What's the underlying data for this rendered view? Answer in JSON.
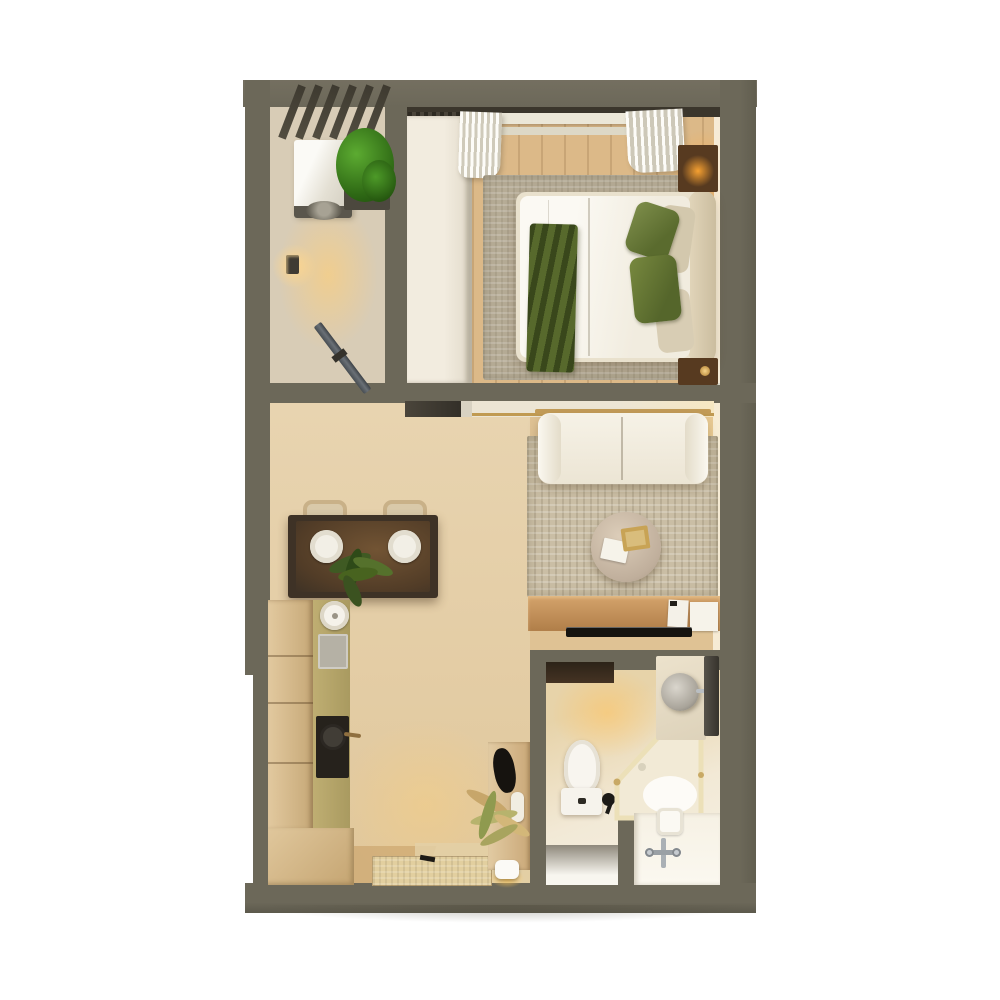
{
  "scene": {
    "type": "floor-plan-3d-render",
    "view": "top-down",
    "background_color": "#ffffff",
    "wall_color": "#6c6859"
  },
  "palette": {
    "wall": "#6c6859",
    "wood_floor_light": "#e6d1ab",
    "wood_floor_warm": "#dcb988",
    "bedroom_rug": "#b6ac96",
    "living_rug": "#cabea5",
    "sofa_cream": "#f3eee2",
    "accent_green_dark": "#4b5a26",
    "accent_green_pillow": "#6e7e3e",
    "gold": "#c39c58",
    "dark_table_wood": "#3e3226",
    "console_wood": "#c5925c",
    "white_fixture": "#f7f3ec",
    "plant_green": "#3f7a22"
  },
  "rooms": [
    {
      "name": "balcony",
      "items": [
        "pergola-slats",
        "washing-machine",
        "planter-plant",
        "wall-sconce",
        "drying-rack"
      ]
    },
    {
      "name": "bedroom",
      "items": [
        "wardrobe",
        "curtain-rod",
        "curtain-left",
        "curtain-right",
        "window-sill",
        "area-rug",
        "double-bed",
        "white-duvet",
        "green-throw-blanket",
        "green-pillow-upper",
        "green-pillow-lower",
        "beige-pillow-upper",
        "beige-pillow-lower",
        "headboard",
        "nightstand-with-lamp",
        "nightstand"
      ]
    },
    {
      "name": "living-room",
      "items": [
        "white-sofa",
        "gold-sofa-frame",
        "woven-rug",
        "round-marble-coffee-table",
        "white-book",
        "gold-tray",
        "tv-console",
        "flat-tv",
        "window-sill",
        "sliding-door-recess"
      ]
    },
    {
      "name": "dining-area",
      "items": [
        "dark-wood-dining-table",
        "dining-chair-left",
        "dining-chair-right",
        "white-plate-left",
        "white-plate-right",
        "table-plant"
      ]
    },
    {
      "name": "kitchen",
      "items": [
        "tall-cabinet-column",
        "countertop",
        "round-sink",
        "cutting-board",
        "cooktop-with-pan",
        "corner-cabinet"
      ]
    },
    {
      "name": "entry",
      "items": [
        "shoe-console",
        "black-bag",
        "vase",
        "dried-plant",
        "entry-mat",
        "robot-vacuum"
      ]
    },
    {
      "name": "bathroom",
      "items": [
        "toilet",
        "bidet-sprayer",
        "corner-shower-glass",
        "round-basin",
        "marble-counter",
        "towel-panel",
        "vanity-counter",
        "chrome-faucet",
        "soap-tray",
        "dark-shelf",
        "door-niche"
      ]
    }
  ]
}
